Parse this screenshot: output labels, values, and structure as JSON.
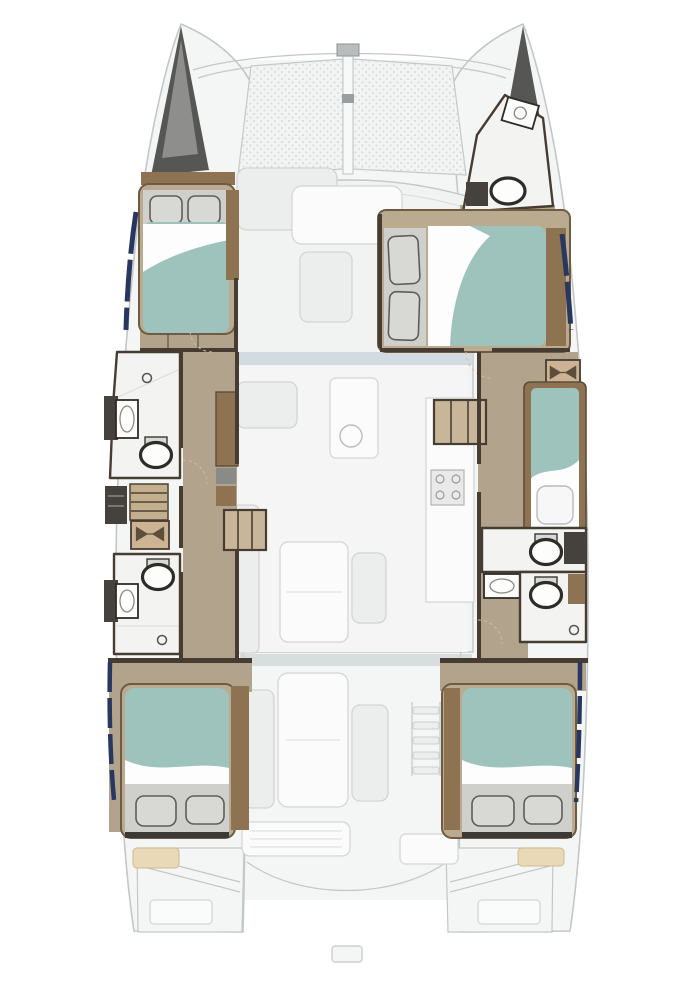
{
  "diagram": {
    "type": "floor-plan",
    "subject": "catamaran yacht layout, top-down view, bow up",
    "bed_count": 5,
    "bathroom_count": 5
  },
  "areas": {
    "boat": "Catamaran deck plan",
    "trampoline": "Bow trampoline nets",
    "port_bow_locker": "Port anchor locker",
    "starboard_bow_locker": "Starboard anchor locker",
    "starboard_bow_head": "Starboard bow bathroom",
    "port_forward_cabin": "Port forward cabin with double bed",
    "starboard_forward_cabin": "Starboard forward cabin with double bed",
    "port_forward_head": "Port forward bathroom with shower, sink and toilet",
    "port_companionway": "Port companionway stairs and vanity",
    "port_aft_head": "Port aft bathroom with toilet, sink and shower",
    "port_aft_cabin": "Port aft cabin with double bed",
    "starboard_single_berth": "Starboard single berth",
    "starboard_mid_head": "Starboard mid bathroom with toilet and sink",
    "starboard_aft_head": "Starboard aft bathroom with toilet and shower",
    "starboard_aft_cabin": "Starboard aft cabin with double bed",
    "forward_lounge": "Forward cockpit lounge",
    "saloon": "Saloon with settee, table and galley",
    "cockpit": "Aft cockpit with table, seats and ladder",
    "stern": "Transom steps and aft platform"
  },
  "colors": {
    "page_bg": "#ffffff",
    "deck_fill": "#f4f6f6",
    "coach_fill": "#f1f3f3",
    "deck_stroke": "#c3c7c8",
    "furniture_fill": "#eceded",
    "furniture_stroke": "#d2d5d4",
    "furniture_bright": "#fafbfa",
    "tramp_fill": "#f2f3f3",
    "tramp_dot": "#d7dada",
    "locker_dark": "#565654",
    "wall_dark": "#463c31",
    "wood_trim": "#8d7352",
    "floor_taupe": "#b2a48c",
    "bath_fill": "#f3f3f1",
    "fixture_dark": "#2e2c29",
    "utility_dark": "#45423e",
    "bed_teal": "#9dc3bc",
    "sheet_white": "#fcfdfc",
    "pillow_fill": "#d8d8d5",
    "pillow_stroke": "#5f5d57",
    "pillow_zone": "#cfcfcc",
    "bed_frame": "#b9aa90",
    "bed_frame_edge": "#6e5b44",
    "navy": "#27375f",
    "cream": "#ead9b6",
    "glass_blue": "#ccd7dc",
    "door_arc": "#c9bfa9",
    "tan_seat": "#cbb394",
    "bowtie_dark": "#5d4e3c",
    "step_tan": "#c8b69a",
    "tread_line": "#4c4234"
  }
}
